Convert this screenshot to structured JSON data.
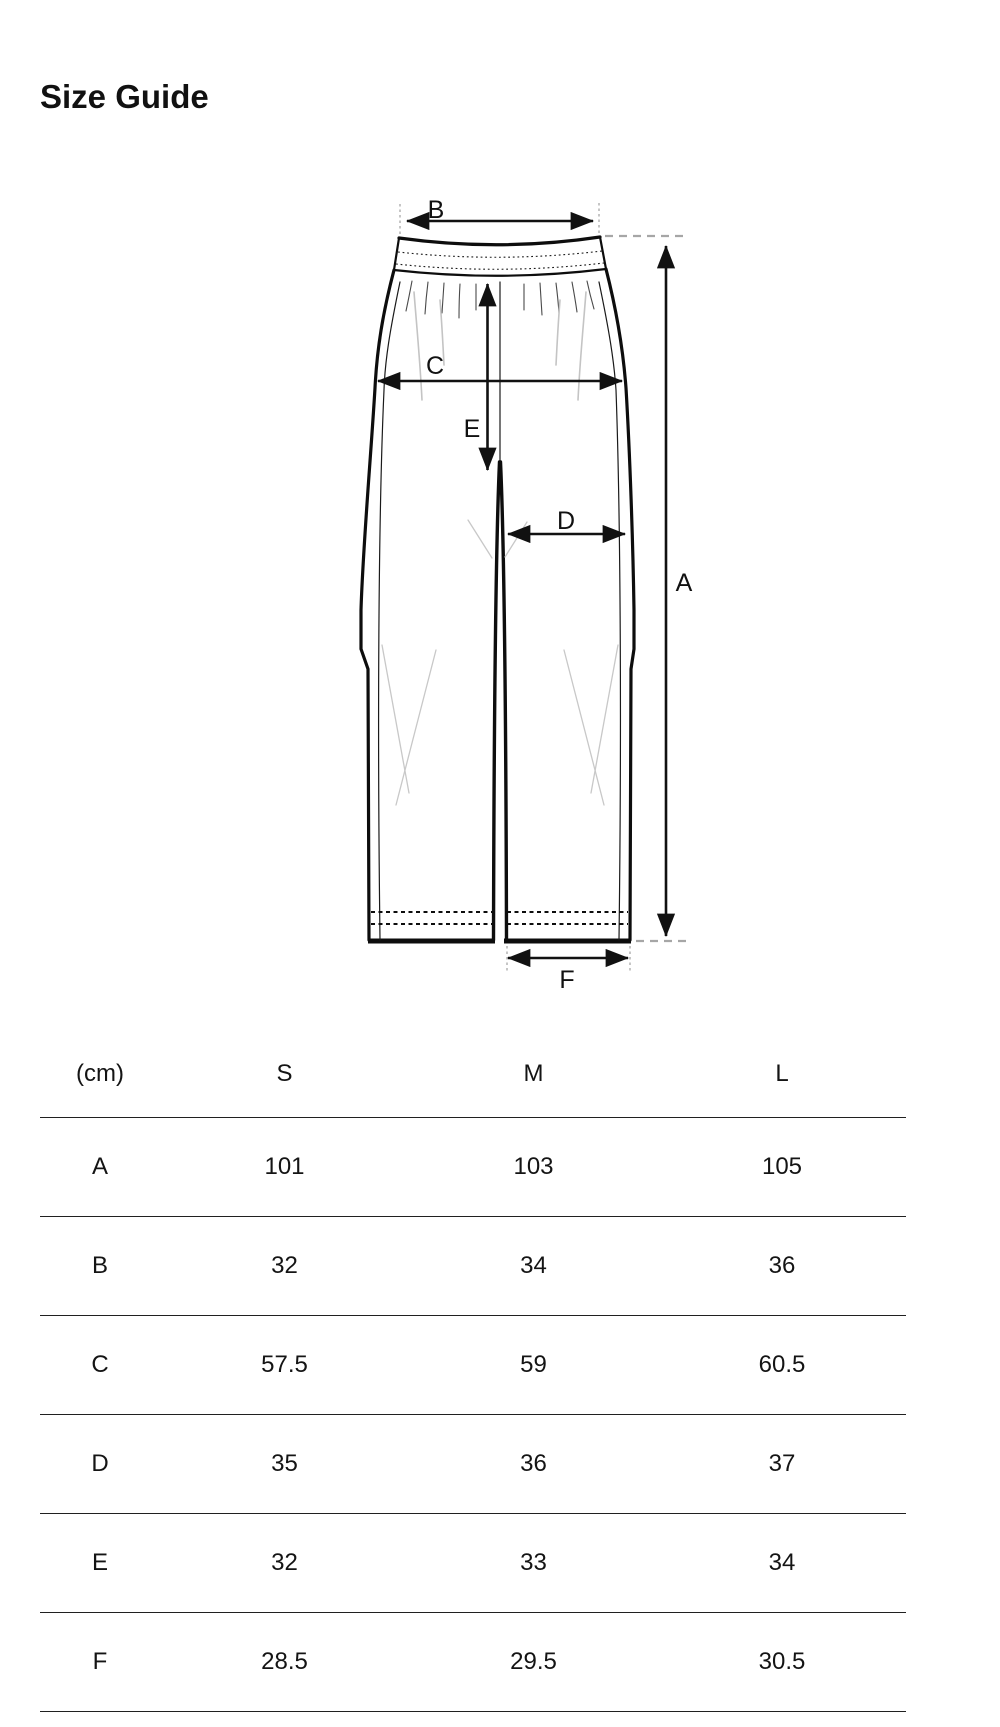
{
  "page": {
    "title": "Size Guide"
  },
  "diagram": {
    "garment": "pants-flat-sketch",
    "labels": {
      "a": "A",
      "b": "B",
      "c": "C",
      "d": "D",
      "e": "E",
      "f": "F"
    }
  },
  "table": {
    "unit_header": "(cm)",
    "columns": [
      "S",
      "M",
      "L"
    ],
    "rows": [
      {
        "label": "A",
        "values": [
          "101",
          "103",
          "105"
        ]
      },
      {
        "label": "B",
        "values": [
          "32",
          "34",
          "36"
        ]
      },
      {
        "label": "C",
        "values": [
          "57.5",
          "59",
          "60.5"
        ]
      },
      {
        "label": "D",
        "values": [
          "35",
          "36",
          "37"
        ]
      },
      {
        "label": "E",
        "values": [
          "32",
          "33",
          "34"
        ]
      },
      {
        "label": "F",
        "values": [
          "28.5",
          "29.5",
          "30.5"
        ]
      }
    ]
  },
  "colors": {
    "background": "#ffffff",
    "ink": "#111111",
    "text": "#141414",
    "table_rule": "#202020",
    "guide_gray": "#a6a6a6",
    "crease_gray": "#c8c8c8"
  }
}
